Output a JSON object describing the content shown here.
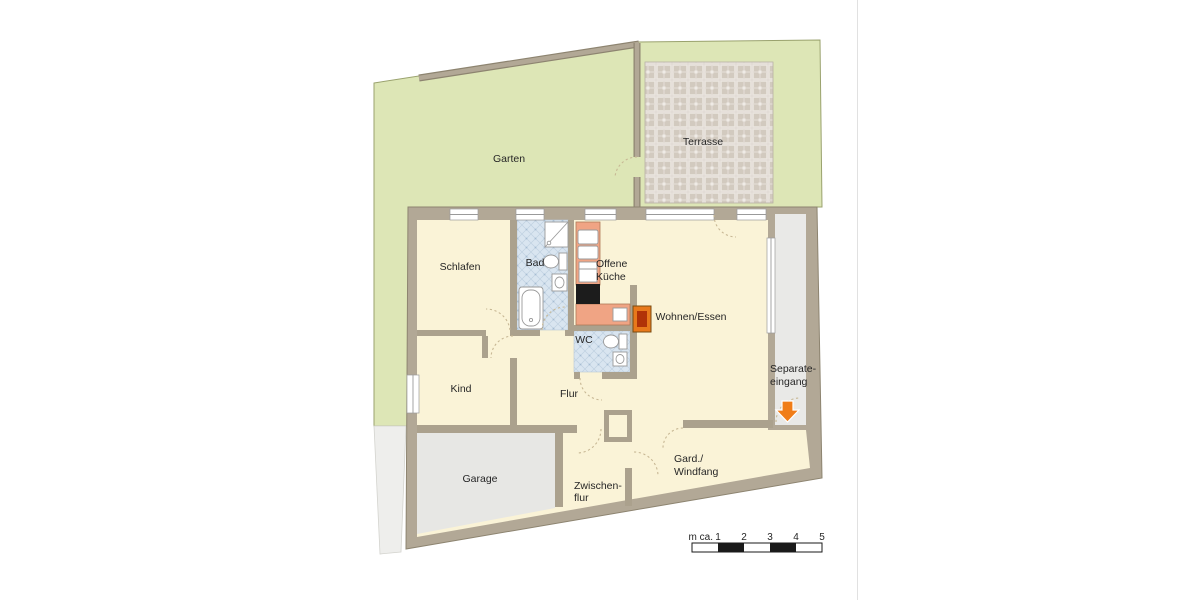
{
  "plan": {
    "outdoor": {
      "garten": "Garten",
      "terrasse": "Terrasse"
    },
    "rooms": {
      "schlafen": "Schlafen",
      "bad": "Bad",
      "offene_kueche": [
        "Offene",
        "Küche"
      ],
      "wohnen_essen": "Wohnen/Essen",
      "kind": "Kind",
      "flur": "Flur",
      "wc": "WC",
      "garage": "Garage",
      "zwischenflur": [
        "Zwischen-",
        "flur"
      ],
      "gard_windfang": [
        "Gard./",
        "Windfang"
      ],
      "separate_eingang": [
        "Separate-",
        "eingang"
      ]
    },
    "scale_bar": {
      "prefix": "m ca.",
      "ticks": [
        "1",
        "2",
        "3",
        "4",
        "5"
      ]
    },
    "icons": {
      "entrance_arrow": "down-arrow"
    },
    "colors": {
      "garden_green": "#dde6b6",
      "terrace_tile": "#d5cec6",
      "wall_tan": "#b2a896",
      "room_cream": "#faf3d7",
      "wet_room_blue": "#d9e5f0",
      "garage_gray": "#e7e7e4",
      "corridor_gray": "#e9e9e7",
      "counter_salmon": "#f0a484",
      "stove_black": "#1c1c1c",
      "fireplace_orange": "#e8791c",
      "arrow_orange": "#f07d18"
    }
  }
}
